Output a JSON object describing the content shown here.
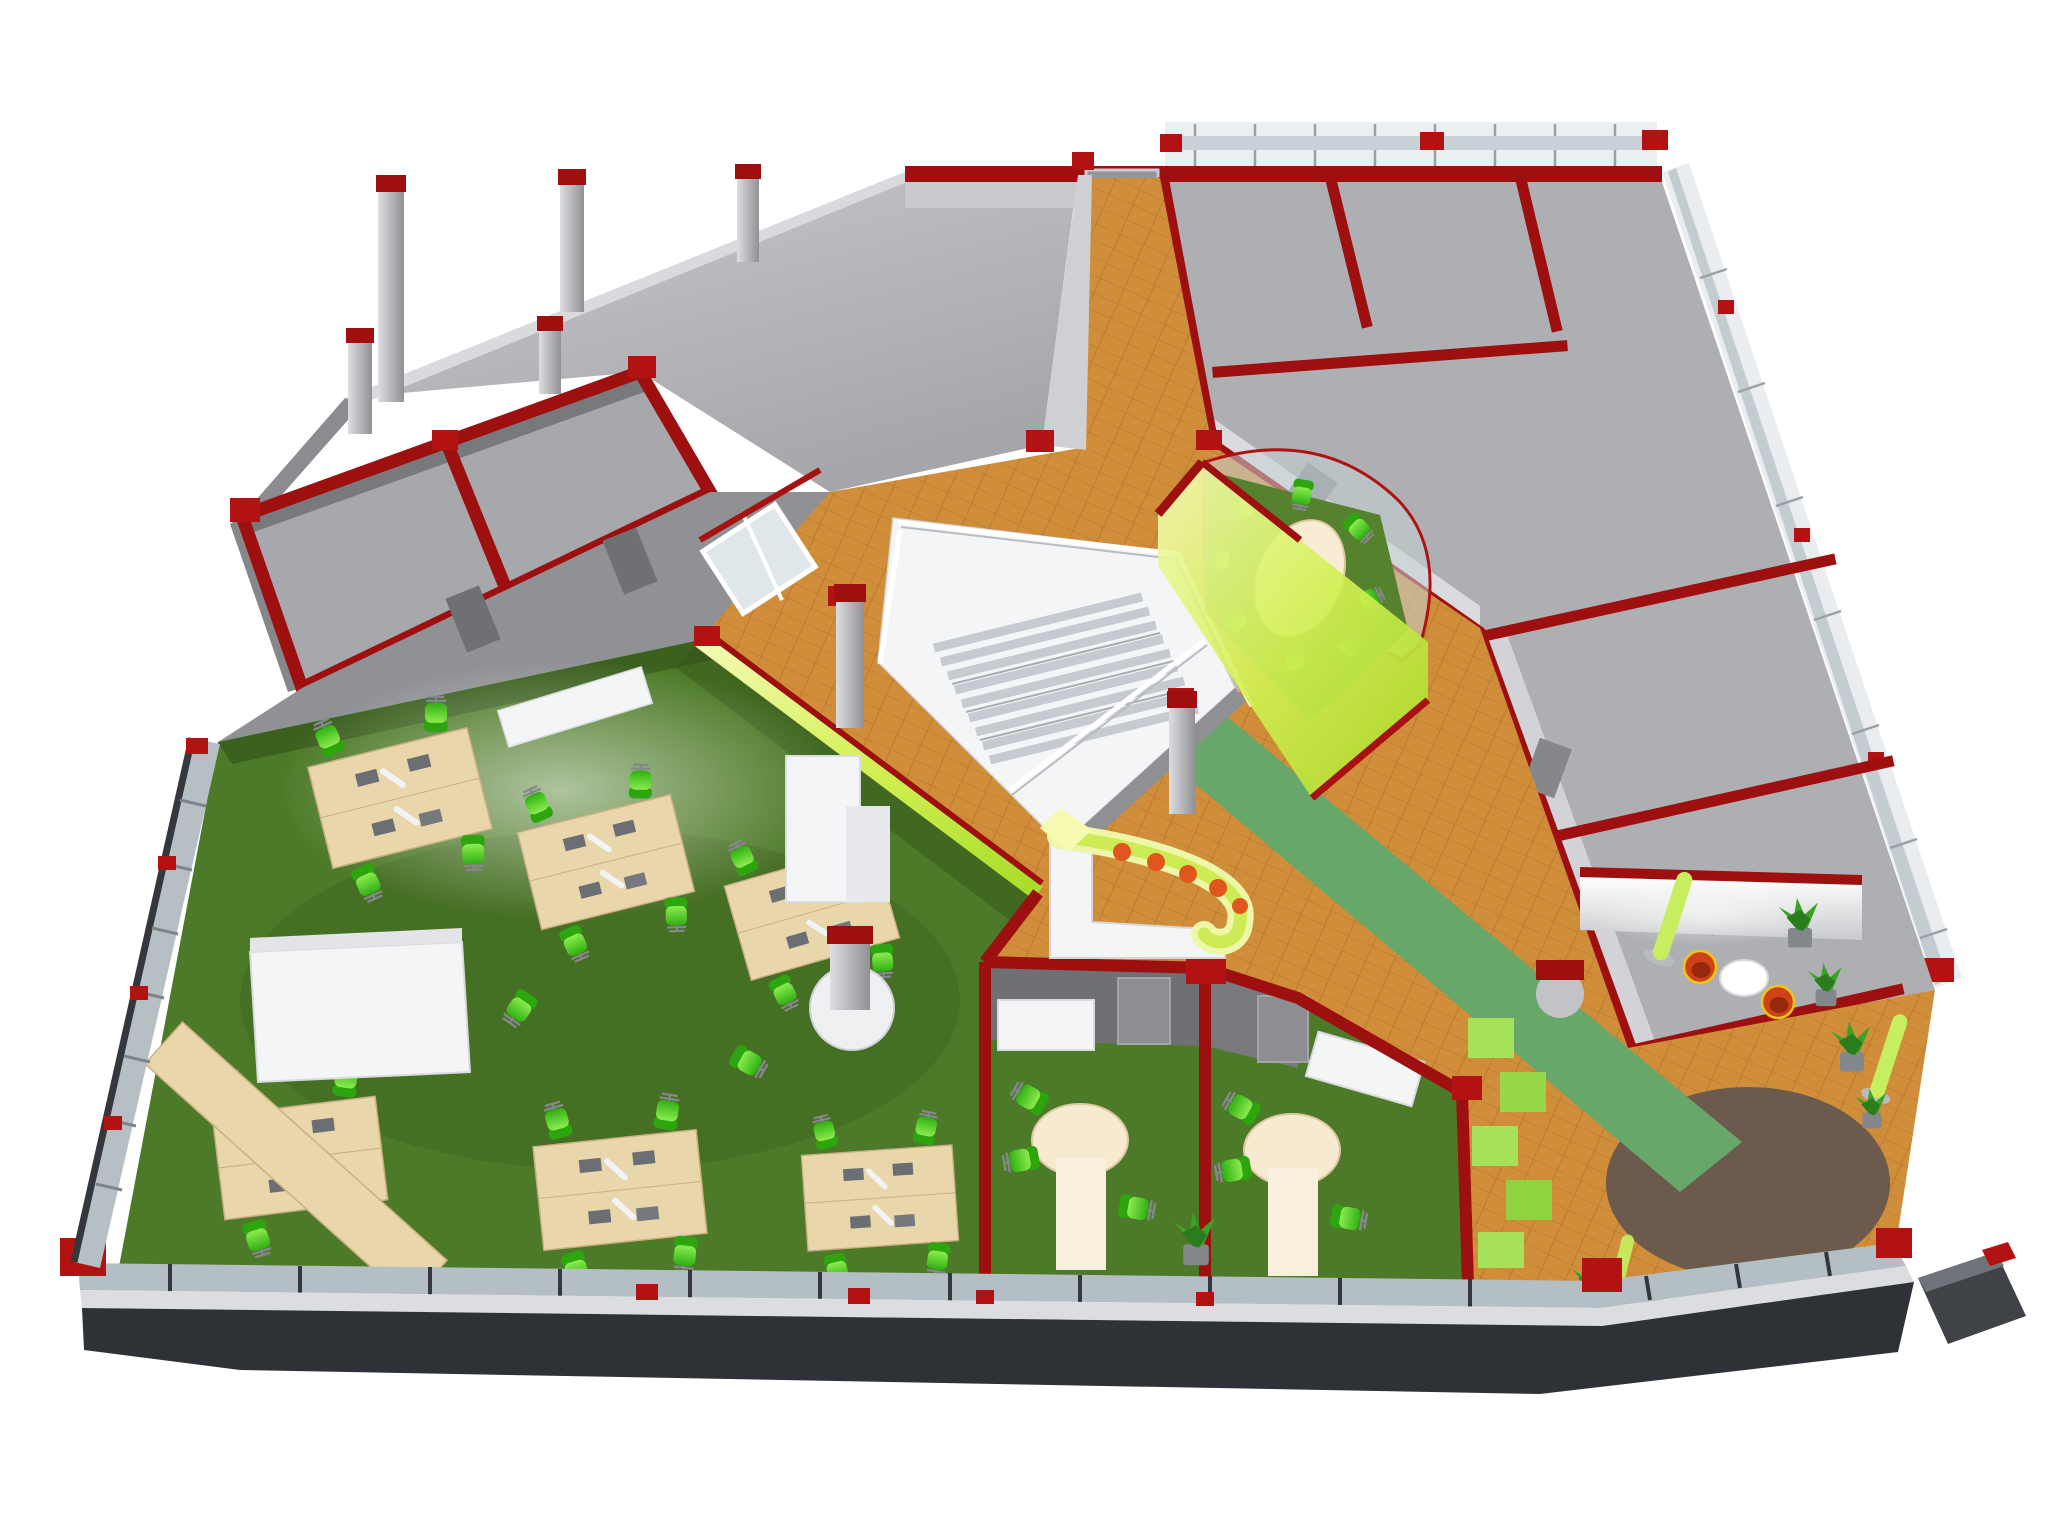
{
  "meta": {
    "type": "3d-axonometric-office-floor-plan-render",
    "view": "isometric cutaway of one office storey",
    "background": "#ffffff"
  },
  "palette": {
    "bg": "#ffffff",
    "slab_light": "#c6c7cb",
    "slab_mid": "#aeafb3",
    "slab_dark": "#96979b",
    "wall_face": "#c9cacd",
    "wall_dark": "#7e8084",
    "wall_deep": "#6a6c70",
    "wall_red": "#9e0f0f",
    "red_bright": "#b31212",
    "orange_floor": "#d18e3a",
    "orange_line": "#a8701f",
    "orange_shade": "#b9792b",
    "runner_green": "#68a76a",
    "carpet": "#4d7a28",
    "carpet_dark": "#38591c",
    "lime": "#bfe93c",
    "lime_pale": "#f0f9b2",
    "wood": "#e9d6ab",
    "wood_light": "#f6ead0",
    "chair_green": "#4ed122",
    "chair_dark": "#2da50f",
    "white_furn": "#f4f5f7",
    "white_shade": "#d7d8db",
    "glass": "#b3bfc4",
    "glass_light": "#d3dcdf",
    "frame_dark": "#34383d",
    "sill": "#dbdde0",
    "plinth": "#2e3136",
    "rug_brown": "#6c5a4d",
    "plant": "#3aa227",
    "plant_dark": "#2a7c1c",
    "tub_orange": "#cd4217",
    "tub_dark": "#96290c",
    "tub_trim": "#f0c518",
    "lamp_lime": "#c6ee5f",
    "metal": "#9a9da1"
  },
  "regions": {
    "structural_slab": {
      "label": "unfinished structural area with columns",
      "floor": "#b4b5b9"
    },
    "left_rooms": {
      "label": "two unfitted rooms, red wall outline",
      "floor": "#a7a8ac"
    },
    "service_corridor": {
      "label": "corridor with doors behind open office",
      "floor": "#8f9194"
    },
    "entrance_corridor": {
      "label": "tiled entrance corridor from top door",
      "floor": "#d18e3a"
    },
    "stair_hall": {
      "label": "stair hall on orange tile",
      "floor": "#d18e3a"
    },
    "staircase": {
      "label": "white open staircase with railings",
      "color": "#f4f5f7"
    },
    "meeting_pod": {
      "label": "glazed lime meeting pod with oval table and 8 chairs",
      "glass": "#bfe93c"
    },
    "right_wing": {
      "label": "unfitted rooms along top-right and right windows",
      "floor": "#aeafb3"
    },
    "atrium_walkway": {
      "label": "diagonal tiled walkway to terrace",
      "floor": "#d18e3a"
    },
    "carpet_runner": {
      "label": "green carpet runner across walkway",
      "color": "#68a76a"
    },
    "open_plan_office": {
      "label": "green-carpet open plan office with desk clusters",
      "floor": "#4d7a28"
    },
    "private_office_1": {
      "label": "meeting office with round table",
      "floor": "#4d7a28"
    },
    "private_office_2": {
      "label": "meeting office with round table",
      "floor": "#4d7a28"
    },
    "reception_counter": {
      "label": "white J-shaped counter with lime light edge and orange stools",
      "accent": "#cdeb55"
    },
    "lounge": {
      "label": "lounge corner, orange tub chairs and plants",
      "chair": "#cd4217"
    },
    "terrace_rug": {
      "label": "round brown carpet",
      "color": "#6c5a4d"
    },
    "green_steps": {
      "label": "stepped lime floor tiles",
      "color": "#a5e25a"
    },
    "facade": {
      "label": "glazed facade with dark frames and red accents",
      "glass": "#b3bfc4"
    }
  },
  "furniture": {
    "desk_clusters": 7,
    "window_side_desks": 2,
    "task_chairs": 34,
    "round_tables": 2,
    "oval_meeting_table": 1,
    "tub_chairs": 4,
    "lounge_tables": 2,
    "plants": 9,
    "structural_columns": 9,
    "green_floor_cubes": 5,
    "lime_lamp_columns": 3,
    "white_cabinets": 8
  }
}
